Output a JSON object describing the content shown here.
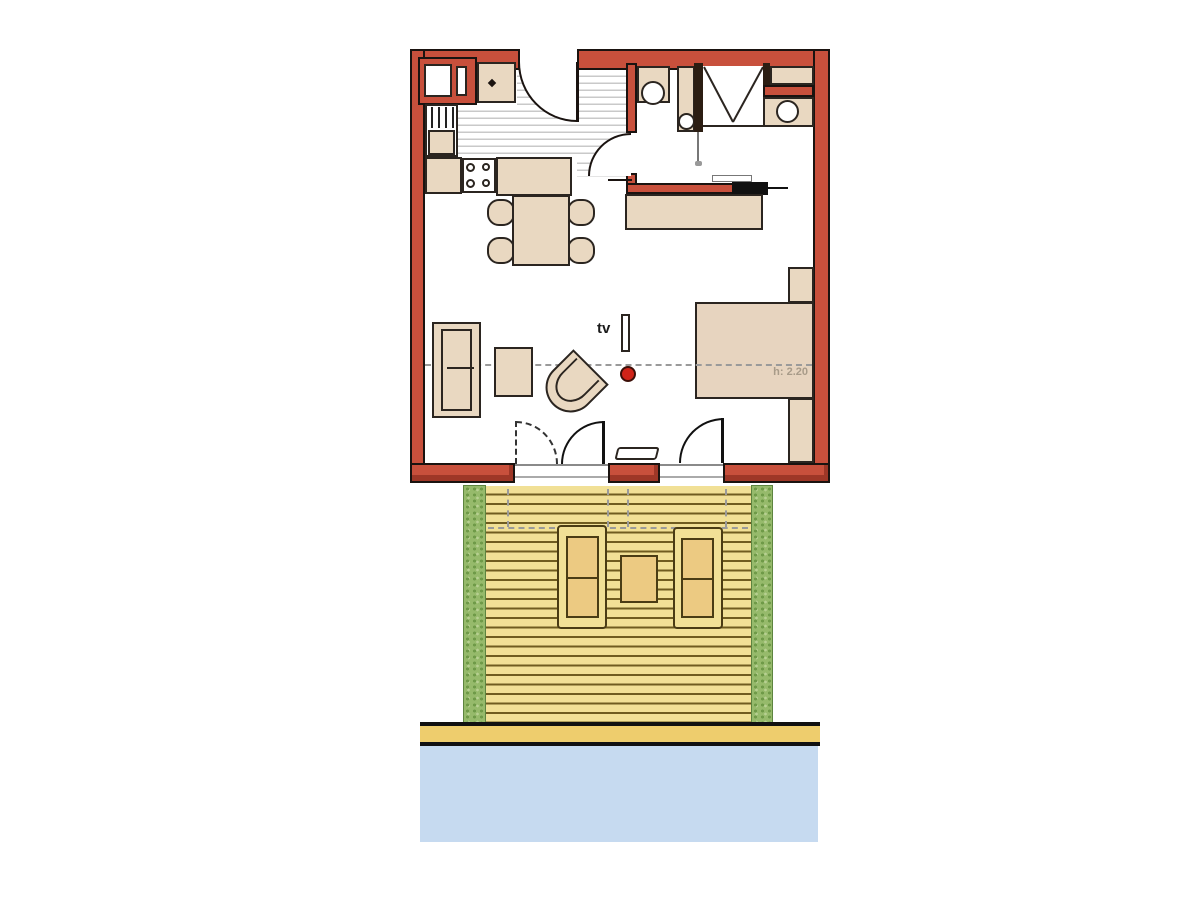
{
  "diagram_type": "apartment-floor-plan-with-terrace",
  "annotations": {
    "tv_label": "tv",
    "ceiling_height_label": "h: 2.20"
  },
  "colors": {
    "wall_red": "#c8503c",
    "wall_dark": "#a33524",
    "outline": "#1a1310",
    "furniture": "#e9d8c1",
    "furniture_border": "#2b2520",
    "dark_fixture": "#2b1d12",
    "stripe": "#c9c9c9",
    "dash": "#9a9a9a",
    "dot_red": "#d02318",
    "deck_bg": "#f1e096",
    "deck_line": "#6f5c20",
    "lounger": "#ecca82",
    "lounger_border": "#4a3c14",
    "hedge": "#96ba6b",
    "hedge_dot": "#6f9a48",
    "sand": "#eecd6d",
    "water": "#c6daf0",
    "text_gray": "#a89b89",
    "text_dark": "#1b1b1b"
  },
  "plan_elements": [
    "kitchen-counter",
    "stove-4-burners",
    "kitchen-sink",
    "dining-table-4-chairs",
    "entry-hall-tiles",
    "entry-door",
    "toilet",
    "washbasin",
    "shower",
    "vanity-basin",
    "desk-sideboard",
    "sofa",
    "coffee-table",
    "tub-chair",
    "tv",
    "double-bed",
    "wardrobe-strips",
    "french-doors",
    "terrace-deck",
    "sun-loungers",
    "deck-table",
    "hedges",
    "boardwalk",
    "water"
  ]
}
